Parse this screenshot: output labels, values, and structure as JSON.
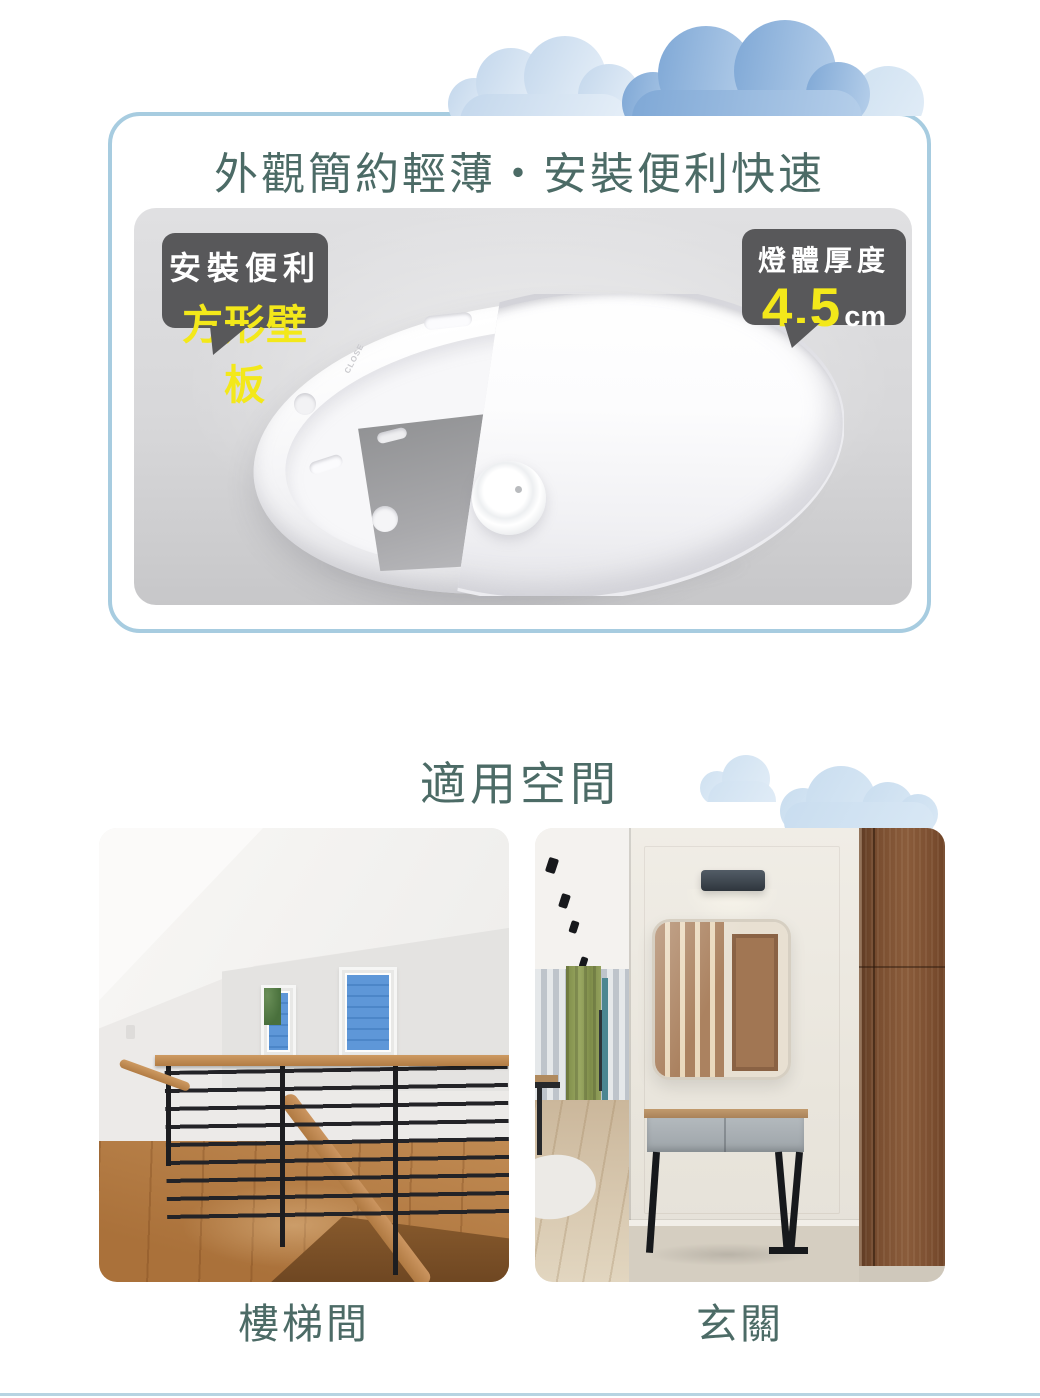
{
  "feature_card": {
    "title": "外觀簡約輕薄・安裝便利快速",
    "badge_left": {
      "line1": "安裝便利",
      "line2": "方形壁板"
    },
    "badge_right": {
      "label": "燈體厚度",
      "value": "4.5",
      "unit": "cm"
    },
    "product_marking": "CLOSE"
  },
  "spaces": {
    "title": "適用空間",
    "items": [
      {
        "caption": "樓梯間"
      },
      {
        "caption": "玄關"
      }
    ]
  },
  "colors": {
    "accent_text": "#4c6b66",
    "badge_bg": "#58585a",
    "highlight_yellow": "#f3e81a",
    "card_border": "#a7cce0",
    "cloud_dark_blue": "#7fa8d6",
    "cloud_light_blue": "#cfe1f1",
    "panel_gray": "#d5d5d7",
    "divider_line": "#b7d4e2"
  }
}
